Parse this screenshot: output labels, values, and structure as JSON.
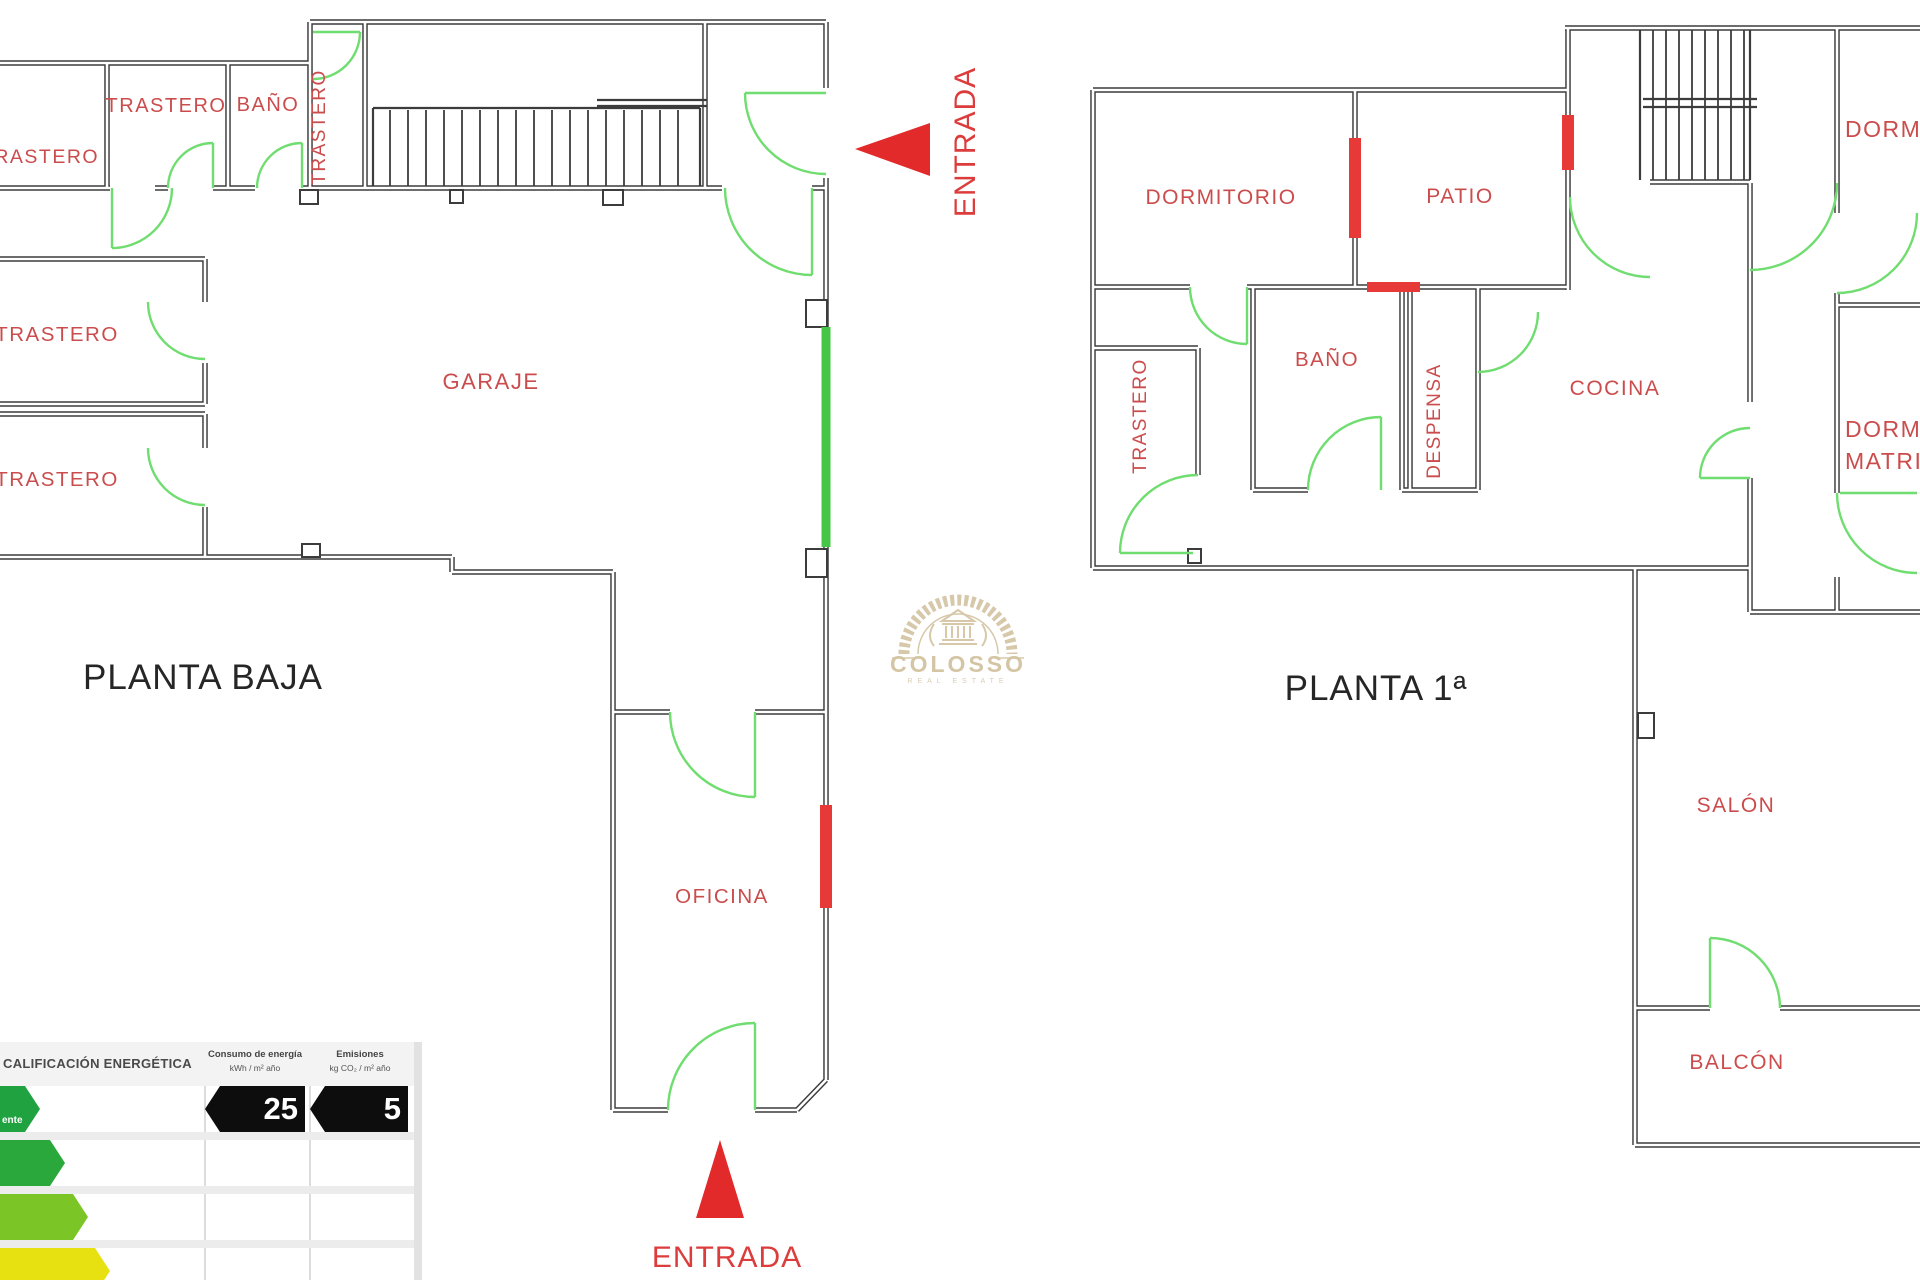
{
  "plans": {
    "planta_baja": {
      "title": "PLANTA BAJA",
      "rooms": {
        "trastero_top_left": "TRASTERO",
        "trastero_top": "TRASTERO",
        "bano": "BAÑO",
        "trastero_vertical": "TRASTERO",
        "trastero_mid": "TRASTERO",
        "trastero_low": "TRASTERO",
        "garaje": "GARAJE",
        "oficina": "OFICINA"
      },
      "entrances": {
        "right": "ENTRADA",
        "bottom": "ENTRADA"
      }
    },
    "planta_primera": {
      "title": "PLANTA 1ª",
      "rooms": {
        "dormitorio": "DORMITORIO",
        "patio": "PATIO",
        "bano": "BAÑO",
        "trastero": "TRASTERO",
        "despensa": "DESPENSA",
        "cocina": "COCINA",
        "dorm_cut": "DORM",
        "dorm_matri_line1": "DORM",
        "dorm_matri_line2": "MATRI",
        "salon": "SALÓN",
        "balcon": "BALCÓN"
      }
    }
  },
  "watermark": {
    "name": "COLOSSO",
    "tagline": "REAL ESTATE"
  },
  "energy_certificate": {
    "title": "CALIFICACIÓN ENERGÉTICA",
    "consumo_header": "Consumo de energía",
    "consumo_units": "kWh / m² año",
    "emisiones_header": "Emisiones",
    "emisiones_units": "kg CO₂ / m² año",
    "rating_label_fragment": "ente",
    "consumo_value": "25",
    "emisiones_value": "5"
  },
  "icons": {
    "entrada_right_triangle": "red triangle pointing left",
    "entrada_bottom_triangle": "red triangle pointing up",
    "rating_arrows": "colored right-pointing rating bars",
    "value_tags": "black left-notched value tags",
    "watermark_arch": "greek-key arch with temple"
  },
  "colors": {
    "wall": "#3c3c3c",
    "label_red": "#cb4c4c",
    "accent_red": "#e22a2a",
    "window_red": "#e83939",
    "door_green": "#6fdd6f",
    "glass_green": "#46c646",
    "title_dark": "#262626",
    "watermark_beige": "#d5c6a6",
    "rating_row1": "#1fa23f",
    "rating_row2": "#2aa83c",
    "rating_row3": "#7cc527",
    "rating_row4": "#e8e112"
  }
}
